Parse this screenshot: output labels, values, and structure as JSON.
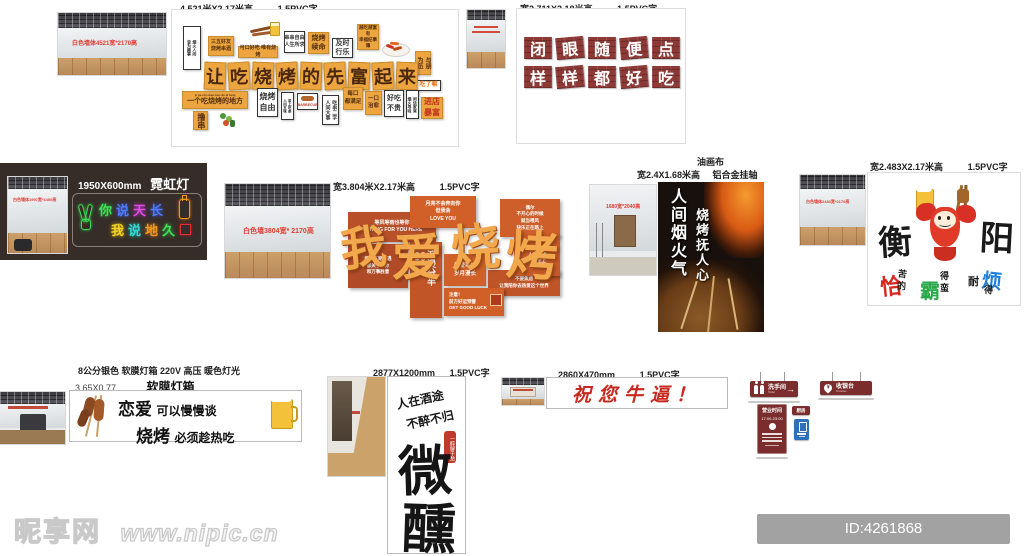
{
  "wall_a": {
    "header": {
      "size": "4.521米X2.17米高",
      "material": "1.5PVC字"
    },
    "photo_note": "白色墙体4521宽*2170高",
    "main_chars": [
      "让",
      "吃",
      "烧",
      "烤",
      "的",
      "先",
      "富",
      "起",
      "来"
    ],
    "tiles": {
      "tall_left": "烟火人间\n皆为趣事",
      "t1": "三五好友\n烧烤串酒",
      "t2": "可口好吃 唯有烧烤",
      "t3": "串串自由\n人生所求",
      "t4": "烧烤\n续命",
      "t5": "及时\n行乐",
      "t6": "越吃越富有\n幸福纪事簿",
      "t7": "与朋\n为伍",
      "t8": "吃了嘛",
      "b1_pinyin": "yi ge chi shao kao de di fang",
      "b1": "一个吃烧烤的地方",
      "b2": "撸串",
      "b3": "烧烤\n自由",
      "b4": "炭上吃串\n人间五味",
      "b5": "BARBECUE",
      "b6": "吃串二字\n人间大事",
      "b7": "每口\n都满足",
      "b8": "一口\n治愈",
      "b9": "好吃\n不贵",
      "b10": "闲话家常\n烟火寻味",
      "b11": "进店\n暴富"
    }
  },
  "wall_b": {
    "header": {
      "size": "宽2.711X2.18米高",
      "material": "1.5PVC字"
    },
    "row1": [
      "闭",
      "眼",
      "随",
      "便",
      "点"
    ],
    "row2": [
      "样",
      "样",
      "都",
      "好",
      "吃"
    ]
  },
  "neon": {
    "size": "1950X600mm",
    "name": "霓虹灯",
    "photo_note": "白色墙体1997宽*1400高",
    "chars1": [
      "你",
      "说",
      "天",
      "长"
    ],
    "chars2": [
      "我",
      "说",
      "地",
      "久"
    ],
    "colors": {
      "green": "#3ee057",
      "blue": "#4f7bff",
      "magenta": "#e04ae0",
      "cyan": "#33d9d0",
      "yellow": "#f5d327",
      "orange": "#f59a1e"
    }
  },
  "wall_d": {
    "header": {
      "size": "宽3.804米X2.17米高",
      "material": "1.5PVC字"
    },
    "photo_note": "白色墙3804宽* 2170高",
    "big_chars": [
      "我",
      "爱",
      "烧",
      "烤"
    ],
    "tiles": {
      "d1": "等风等雨也等你\nWAITING FOR YOU HERE",
      "d2": "月亮不会奔向你\n但我会\nLOVE YOU",
      "d3": "偶尔\n不开心的时候\n就当喂风\n快乐正在路上",
      "d4": "所有不期而遇\n都关于爱你\n和万事胜意",
      "d5_big": "浪漫分半",
      "d5_small": "一串治愈于胃\n一串烟火于心",
      "d6": "热爱可抵\n岁月漫长",
      "d7": "不要焦虑\n让我陪你去热爱这个世界",
      "d8": "注意！\n前方好运预警\nGET GOOD LUCK",
      "d9": "FUN AND HAPPY\n人间一趟\n快乐至上"
    }
  },
  "poster": {
    "header1": "油画布",
    "header2_size": "宽2.4X1.68米高",
    "header2_mount": "铝合金挂轴",
    "photo_note": "1680宽*2040高",
    "col1": "人间烟火气",
    "col2": "烧烤抚人心"
  },
  "hengyang": {
    "header": {
      "size": "宽2.483X2.17米高",
      "material": "1.5PVC字"
    },
    "photo_note": "白色墙体2483宽*2170高",
    "char_left": "衡",
    "char_right": "阳",
    "slogan": {
      "g1_big": "恰",
      "g1_top": "苦",
      "g1_bot": "的",
      "g2_big": "霸",
      "g2_top": "得",
      "g2_bot": "蛮",
      "g3_pre": "耐",
      "g3_big": "烦",
      "g3_bot": "得"
    },
    "slogan_colors": {
      "g1": "#d42a20",
      "g2": "#2aa84a",
      "g3": "#1e7fd6"
    }
  },
  "lightbox": {
    "header1": "8公分银色 软膜灯箱 220V 高压 暖色灯光",
    "header2_size": "3.65X0.77",
    "header2_name": "软膜灯箱",
    "line1_big": "恋爱",
    "line1_rest": "可以慢慢谈",
    "line2_big": "烧烤",
    "line2_rest": "必须趁热吃"
  },
  "weixun": {
    "header": {
      "size": "2877X1200mm",
      "material": "1.5PVC字"
    },
    "top_line1": "人在酒途",
    "top_line2": "不醉不归",
    "seal": "一醉解千愁",
    "big1": "微",
    "big2": "醺"
  },
  "niubi": {
    "header": {
      "size": "2860X470mm",
      "material": "1.5PVC字"
    },
    "text": "祝您牛逼！"
  },
  "signs": {
    "toilet": {
      "cn": "洗手间",
      "en": "Toilet",
      "arrow": "→"
    },
    "counter": {
      "cn": "收银台",
      "en": "Counter",
      "pin": "¥"
    },
    "hours": {
      "title": "营业时间",
      "time": "17:00-23:00"
    },
    "kitchen": "厨房"
  },
  "watermark": {
    "site": "昵享网",
    "url": "www.nipic.cn"
  },
  "idbar": {
    "text": "ID:4261868 NO:20250815155821504101"
  }
}
